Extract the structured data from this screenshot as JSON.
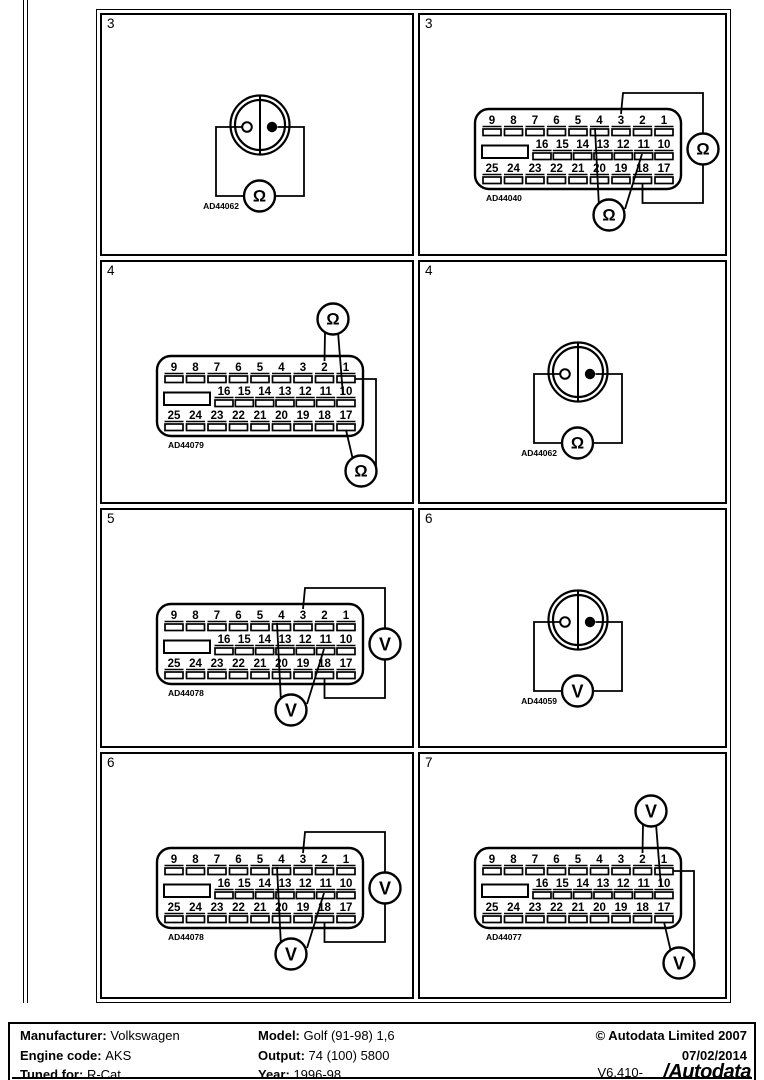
{
  "panels": [
    {
      "num": "3",
      "type": "round-2pin",
      "connector_id": "AD44062",
      "meters": [
        {
          "symbol": "Ω",
          "name": "ohmmeter",
          "position": "bottom",
          "connects": [
            "left-pin",
            "right-pin"
          ]
        }
      ]
    },
    {
      "num": "3",
      "type": "db25",
      "connector_id": "AD44040",
      "meters": [
        {
          "symbol": "Ω",
          "name": "ohmmeter",
          "position": "right",
          "connects": [
            "3",
            "18"
          ]
        },
        {
          "symbol": "Ω",
          "name": "ohmmeter",
          "position": "bottom",
          "connects": [
            "4",
            "11"
          ]
        }
      ]
    },
    {
      "num": "4",
      "type": "db25",
      "connector_id": "AD44079",
      "meters": [
        {
          "symbol": "Ω",
          "name": "ohmmeter",
          "position": "top",
          "connects": [
            "2",
            "10"
          ]
        },
        {
          "symbol": "Ω",
          "name": "ohmmeter",
          "position": "bottom-right",
          "connects": [
            "1",
            "17"
          ]
        }
      ]
    },
    {
      "num": "4",
      "type": "round-2pin",
      "connector_id": "AD44062",
      "meters": [
        {
          "symbol": "Ω",
          "name": "ohmmeter",
          "position": "bottom",
          "connects": [
            "left-pin",
            "right-pin"
          ]
        }
      ]
    },
    {
      "num": "5",
      "type": "db25",
      "connector_id": "AD44078",
      "meters": [
        {
          "symbol": "V",
          "name": "voltmeter",
          "position": "right",
          "connects": [
            "3",
            "18"
          ]
        },
        {
          "symbol": "V",
          "name": "voltmeter",
          "position": "bottom",
          "connects": [
            "4",
            "11"
          ]
        }
      ]
    },
    {
      "num": "6",
      "type": "round-2pin",
      "connector_id": "AD44059",
      "meters": [
        {
          "symbol": "V",
          "name": "voltmeter",
          "position": "bottom",
          "connects": [
            "left-pin",
            "right-pin"
          ]
        }
      ]
    },
    {
      "num": "6",
      "type": "db25",
      "connector_id": "AD44078",
      "meters": [
        {
          "symbol": "V",
          "name": "voltmeter",
          "position": "right",
          "connects": [
            "3",
            "18"
          ]
        },
        {
          "symbol": "V",
          "name": "voltmeter",
          "position": "bottom",
          "connects": [
            "4",
            "11"
          ]
        }
      ]
    },
    {
      "num": "7",
      "type": "db25",
      "connector_id": "AD44077",
      "meters": [
        {
          "symbol": "V",
          "name": "voltmeter",
          "position": "top",
          "connects": [
            "2",
            "10"
          ]
        },
        {
          "symbol": "V",
          "name": "voltmeter",
          "position": "bottom-right",
          "connects": [
            "1",
            "17"
          ]
        }
      ]
    }
  ],
  "db25_pins": {
    "row1": [
      "9",
      "8",
      "7",
      "6",
      "5",
      "4",
      "3",
      "2",
      "1"
    ],
    "row2": [
      "16",
      "15",
      "14",
      "13",
      "12",
      "11",
      "10"
    ],
    "row3": [
      "25",
      "24",
      "23",
      "22",
      "21",
      "20",
      "19",
      "18",
      "17"
    ]
  },
  "colors": {
    "ink": "#000000",
    "paper": "#ffffff"
  },
  "footer": {
    "rows": [
      {
        "left_label": "Manufacturer:",
        "left_value": "Volkswagen",
        "mid_label": "Model:",
        "mid_value": "Golf (91-98) 1,6",
        "right": "© Autodata Limited 2007"
      },
      {
        "left_label": "Engine code:",
        "left_value": "AKS",
        "mid_label": "Output:",
        "mid_value": "74 (100) 5800",
        "right": "07/02/2014"
      },
      {
        "left_label": "Tuned for:",
        "left_value": "R-Cat",
        "mid_label": "Year:",
        "mid_value": "1996-98",
        "right": "V6.410-"
      }
    ],
    "logo_text": "/Autodata"
  }
}
